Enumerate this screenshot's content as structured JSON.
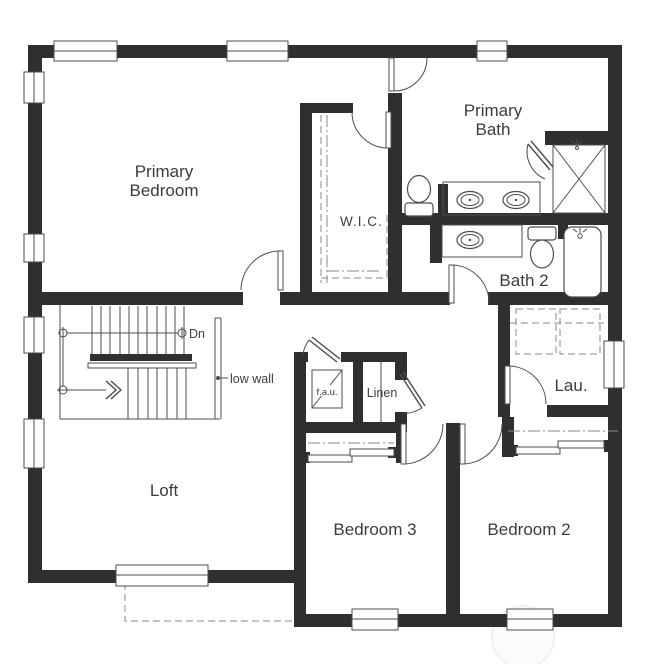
{
  "floorplan": {
    "title": "Second floor plan",
    "rooms": {
      "primary_bedroom": {
        "line1": "Primary",
        "line2": "Bedroom"
      },
      "primary_bath": {
        "line1": "Primary",
        "line2": "Bath"
      },
      "wic": {
        "label": "W.I.C."
      },
      "bath2": {
        "label": "Bath 2"
      },
      "laundry": {
        "label": "Lau."
      },
      "loft": {
        "label": "Loft"
      },
      "bedroom3": {
        "label": "Bedroom 3"
      },
      "bedroom2": {
        "label": "Bedroom 2"
      },
      "fau_closet": {
        "label": "f.a.u."
      },
      "linen": {
        "label": "Linen"
      }
    },
    "annotations": {
      "stair_direction": "Dn",
      "low_wall": "low wall"
    },
    "colors": {
      "wall": "#2f2f2f",
      "line": "#4d4d4d",
      "dash": "#8a8a8a",
      "text": "#3c3c3c",
      "background": "#ffffff",
      "watermark": "#f2efef"
    }
  }
}
